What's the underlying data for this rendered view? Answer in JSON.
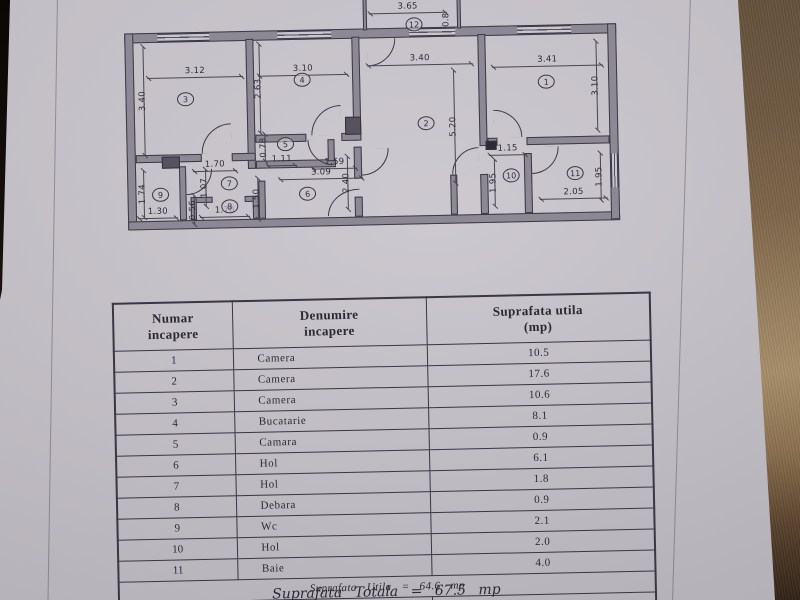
{
  "document": {
    "plan": {
      "dims": [
        {
          "text": "3.65",
          "o": "h",
          "x": 375,
          "y": 14,
          "len": 78
        },
        {
          "text": "0.8",
          "o": "v",
          "x": 453,
          "y": 8,
          "len": 26,
          "noline": true
        },
        {
          "text": "3.12",
          "o": "h",
          "x": 152,
          "y": 74,
          "len": 96
        },
        {
          "text": "3.40",
          "o": "v",
          "x": 148,
          "y": 42,
          "len": 108
        },
        {
          "text": "3.10",
          "o": "h",
          "x": 263,
          "y": 74,
          "len": 90
        },
        {
          "text": "2.63",
          "o": "v",
          "x": 264,
          "y": 42,
          "len": 88
        },
        {
          "text": "3.40",
          "o": "h",
          "x": 372,
          "y": 66,
          "len": 106
        },
        {
          "text": "5.20",
          "o": "v",
          "x": 458,
          "y": 72,
          "len": 112
        },
        {
          "text": "3.41",
          "o": "h",
          "x": 497,
          "y": 70,
          "len": 111
        },
        {
          "text": "3.10",
          "o": "v",
          "x": 601,
          "y": 46,
          "len": 88
        },
        {
          "text": "0.78",
          "o": "v",
          "x": 268,
          "y": 132,
          "len": 26
        },
        {
          "text": "1.11",
          "o": "h",
          "x": 270,
          "y": 164,
          "len": 30
        },
        {
          "text": "1.59",
          "o": "h",
          "x": 315,
          "y": 168,
          "len": 45
        },
        {
          "text": "3.09",
          "o": "h",
          "x": 282,
          "y": 178,
          "len": 84
        },
        {
          "text": "2.40",
          "o": "v",
          "x": 350,
          "y": 156,
          "len": 52
        },
        {
          "text": "1.70",
          "o": "h",
          "x": 196,
          "y": 168,
          "len": 44
        },
        {
          "text": "1.07",
          "o": "v",
          "x": 208,
          "y": 166,
          "len": 36
        },
        {
          "text": "1.74",
          "o": "v",
          "x": 146,
          "y": 166,
          "len": 46
        },
        {
          "text": "1.30",
          "o": "h",
          "x": 140,
          "y": 214,
          "len": 40
        },
        {
          "text": "0.56",
          "o": "v",
          "x": 196,
          "y": 192,
          "len": 28
        },
        {
          "text": "1.70",
          "o": "h",
          "x": 202,
          "y": 214,
          "len": 50
        },
        {
          "text": "1.50",
          "o": "v",
          "x": 260,
          "y": 176,
          "len": 40
        },
        {
          "text": "1.15",
          "o": "h",
          "x": 492,
          "y": 158,
          "len": 38
        },
        {
          "text": "1.95",
          "o": "v",
          "x": 497,
          "y": 162,
          "len": 46
        },
        {
          "text": "1.95",
          "o": "v",
          "x": 603,
          "y": 158,
          "len": 46
        },
        {
          "text": "2.05",
          "o": "h",
          "x": 542,
          "y": 203,
          "len": 68
        }
      ],
      "room_numbers": [
        {
          "n": "1",
          "x": 551,
          "y": 85
        },
        {
          "n": "2",
          "x": 430,
          "y": 124
        },
        {
          "n": "3",
          "x": 190,
          "y": 95
        },
        {
          "n": "4",
          "x": 307,
          "y": 78
        },
        {
          "n": "5",
          "x": 289,
          "y": 142
        },
        {
          "n": "6",
          "x": 310,
          "y": 192
        },
        {
          "n": "7",
          "x": 232,
          "y": 180
        },
        {
          "n": "8",
          "x": 232,
          "y": 203
        },
        {
          "n": "9",
          "x": 163,
          "y": 190
        },
        {
          "n": "10",
          "x": 514,
          "y": 178
        },
        {
          "n": "11",
          "x": 578,
          "y": 177
        },
        {
          "n": "12",
          "x": 420,
          "y": 25
        }
      ]
    },
    "table": {
      "headers": [
        "Numar\nincapere",
        "Denumire\nincapere",
        "Suprafata utila\n(mp)"
      ],
      "rows": [
        {
          "nr": "1",
          "name": "Camera",
          "area": "10.5"
        },
        {
          "nr": "2",
          "name": "Camera",
          "area": "17.6"
        },
        {
          "nr": "3",
          "name": "Camera",
          "area": "10.6"
        },
        {
          "nr": "4",
          "name": "Bucatarie",
          "area": "8.1"
        },
        {
          "nr": "5",
          "name": "Camara",
          "area": "0.9"
        },
        {
          "nr": "6",
          "name": "Hol",
          "area": "6.1"
        },
        {
          "nr": "7",
          "name": "Hol",
          "area": "1.8"
        },
        {
          "nr": "8",
          "name": "Debara",
          "area": "0.9"
        },
        {
          "nr": "9",
          "name": "Wc",
          "area": "2.1"
        },
        {
          "nr": "10",
          "name": "Hol",
          "area": "2.0"
        },
        {
          "nr": "11",
          "name": "Baie",
          "area": "4.0"
        }
      ],
      "subtotal": "Suprafata Utila = 64.6 mp",
      "extra_row": {
        "nr": "12",
        "name": "Balcon",
        "area": "2.9"
      },
      "total": "Suprafata Totala = 67.5 mp"
    }
  }
}
